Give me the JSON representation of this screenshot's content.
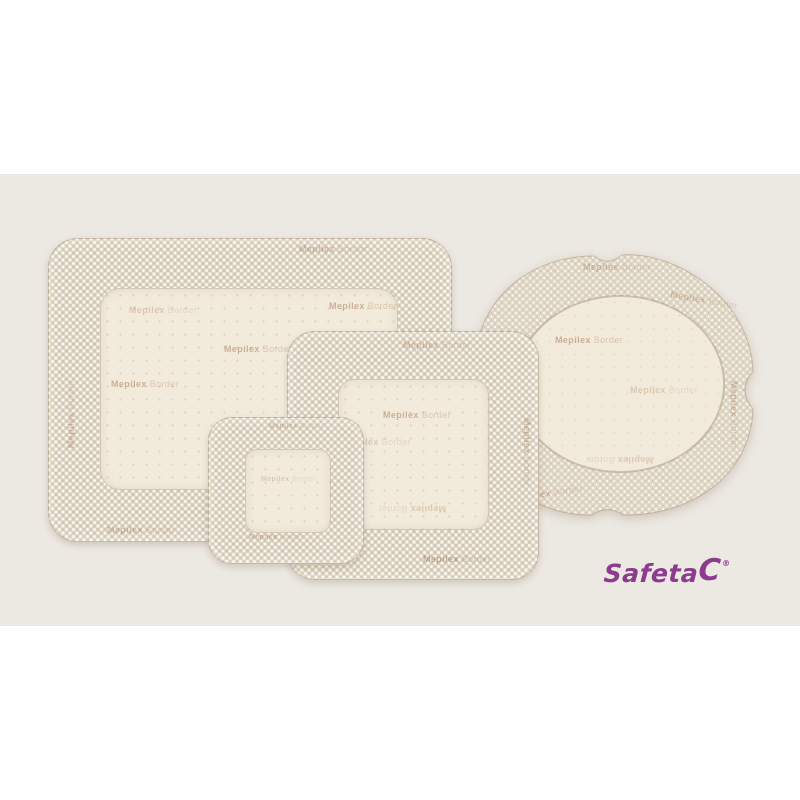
{
  "scene": {
    "description": "Product photo of four Mepilex Border self-adherent foam dressings on a beige backdrop",
    "products": [
      {
        "id": "large-rectangular-dressing",
        "shape": "rounded rectangle",
        "orientation": "landscape"
      },
      {
        "id": "oval-dressing",
        "shape": "oval flower with notched border"
      },
      {
        "id": "medium-square-dressing",
        "shape": "rounded square"
      },
      {
        "id": "small-square-dressing",
        "shape": "rounded square"
      }
    ]
  },
  "brand": {
    "watermark_name": "Mepilex",
    "watermark_sub": "Border",
    "logo_main": "Safeta",
    "logo_cap": "C",
    "logo_registered": "®"
  },
  "colors": {
    "backdrop": "#ECE8E2",
    "adhesive": "#E1D9C8",
    "pad": "#F2EBDC",
    "logo": "#8D3B8F"
  }
}
